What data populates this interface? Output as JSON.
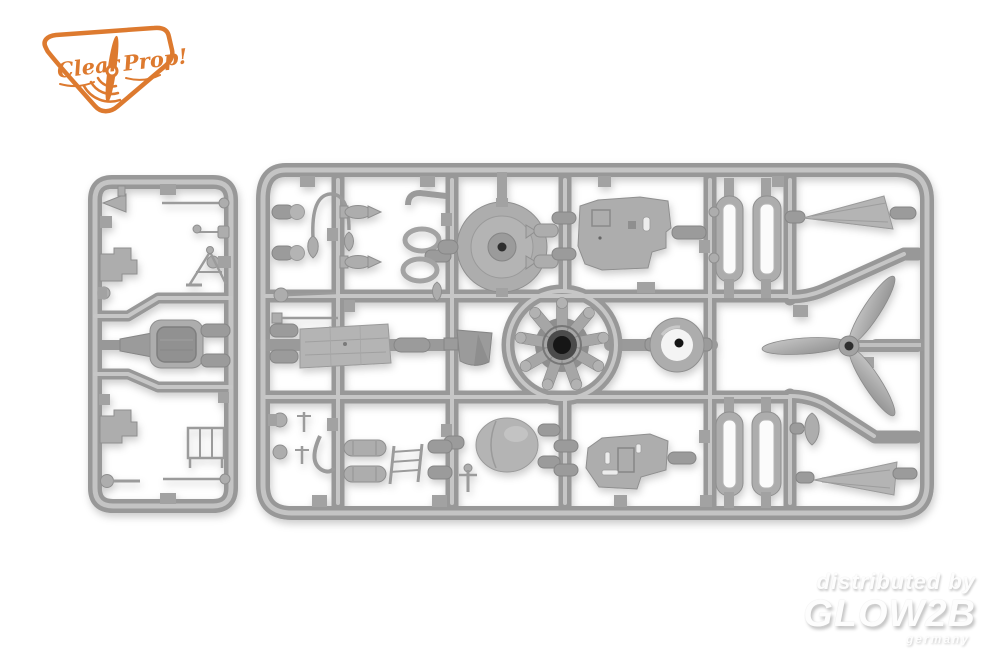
{
  "photo": {
    "description": "grey injection-moulded plastic model kit sprues photographed on a white background",
    "background_color": "#ffffff",
    "plastic_color": "#9a9a9a",
    "plastic_highlight": "#c6c6c6",
    "plastic_shadow": "#8a8a8a"
  },
  "logo": {
    "brand_word_1": "Clear",
    "brand_word_2": "Prop!",
    "color": "#dd7a2f",
    "icon": "propeller-icon"
  },
  "watermark": {
    "line_1": "distributed by",
    "brand": "GLOW2B",
    "country": "germany",
    "text_color": "#ffffff",
    "shadow_color": "#c6c6c6"
  },
  "sprues": {
    "small_sprue": {
      "position": "left",
      "parts": [
        "pilot-seat",
        "stepped-brackets",
        "control-rods",
        "jack-stand",
        "bench-frame",
        "ball-levers",
        "nozzle-fitting",
        "gate-plugs"
      ]
    },
    "large_sprue": {
      "position": "right",
      "parts": [
        "engine-cowling-front",
        "radial-engine",
        "cowl-ring",
        "upper-fuselage-side-panel",
        "lower-fuselage-side-panel",
        "three-blade-propeller",
        "upper-tail-fin",
        "lower-tail-fin",
        "cowl-flap-strips",
        "rear-cowling-egg",
        "wing-center-panel",
        "intake-bucket",
        "drop-tanks",
        "boarding-ladder",
        "teardrop-fairings",
        "oval-frames",
        "bullet-plugs",
        "rigging-rods",
        "curved-strut"
      ]
    }
  }
}
